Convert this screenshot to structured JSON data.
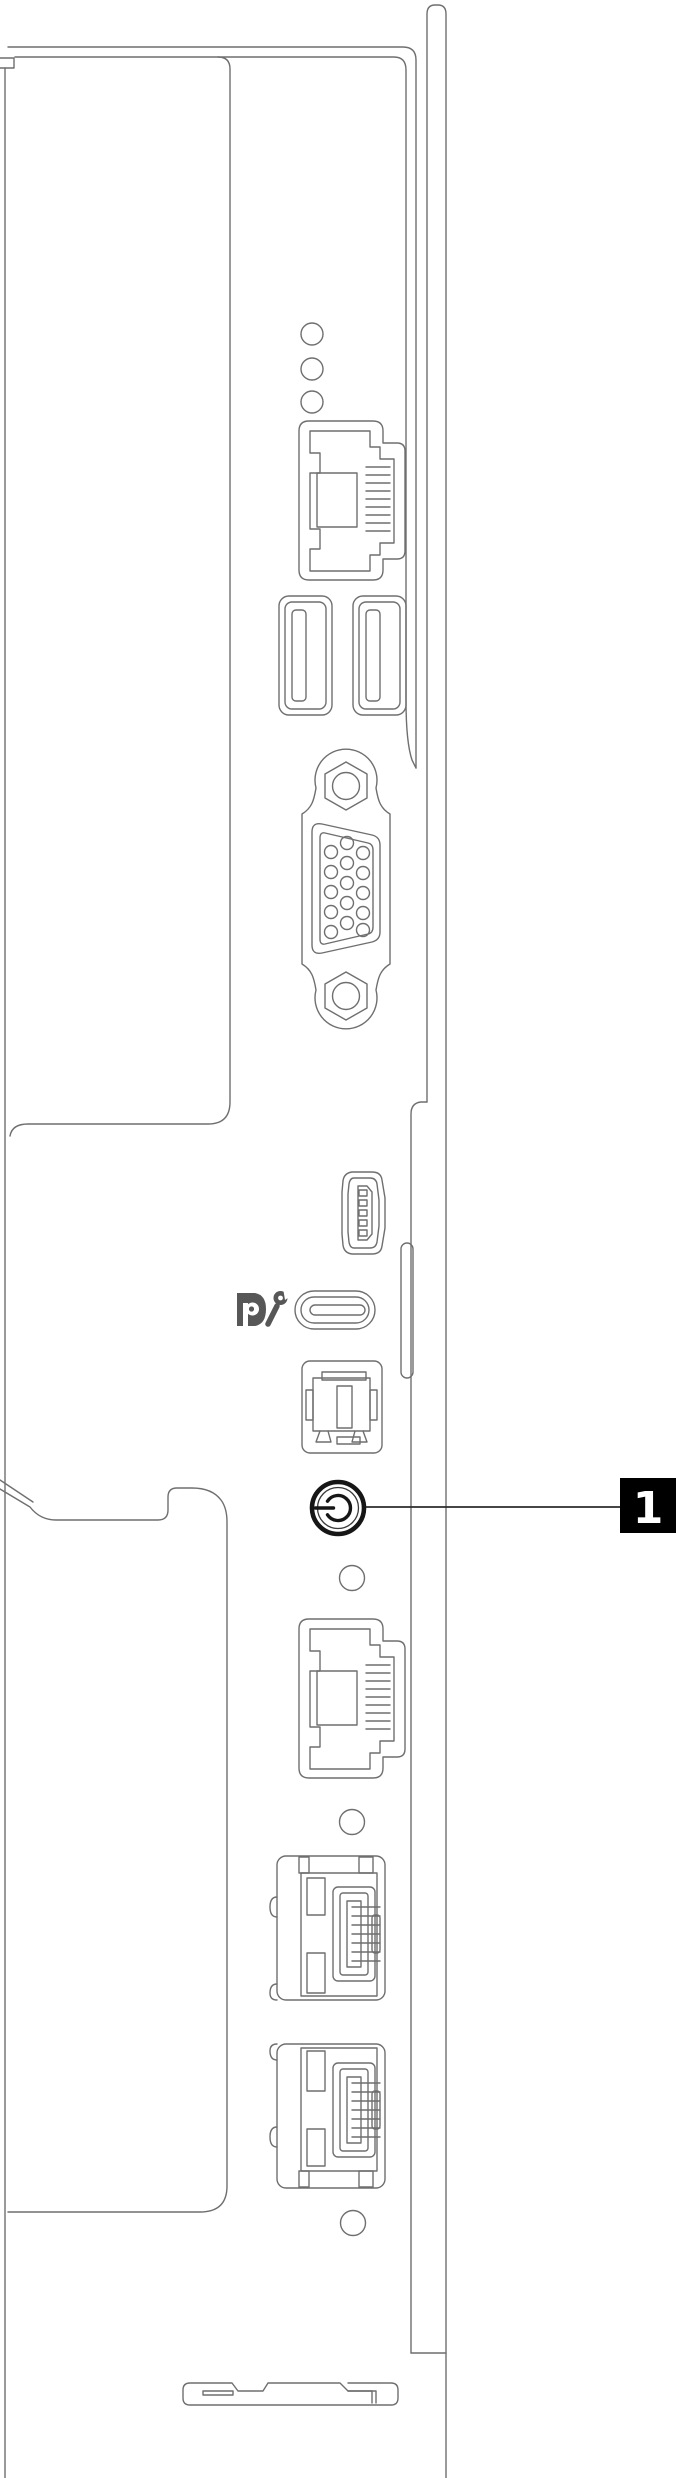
{
  "diagram": {
    "kind": "server-front-panel-line-drawing",
    "callout": {
      "number": "1",
      "target": "power-button"
    },
    "colors": {
      "background": "#ffffff",
      "line": "#6f6f6f",
      "dark": "#1a1a1a",
      "callout_bg": "#000000",
      "callout_text": "#ffffff",
      "logo": "#575757"
    },
    "components": [
      "status-leds",
      "ethernet-port-top",
      "usb-a-port-1",
      "usb-a-port-2",
      "vga-port",
      "mini-usb-port",
      "usb-c-displayport",
      "box-connector",
      "power-button",
      "ethernet-port-middle",
      "network-port-1",
      "network-port-2",
      "screw-holes",
      "bottom-latch"
    ],
    "icons": [
      "displayport-logo-icon",
      "wrench-icon",
      "power-icon"
    ]
  }
}
